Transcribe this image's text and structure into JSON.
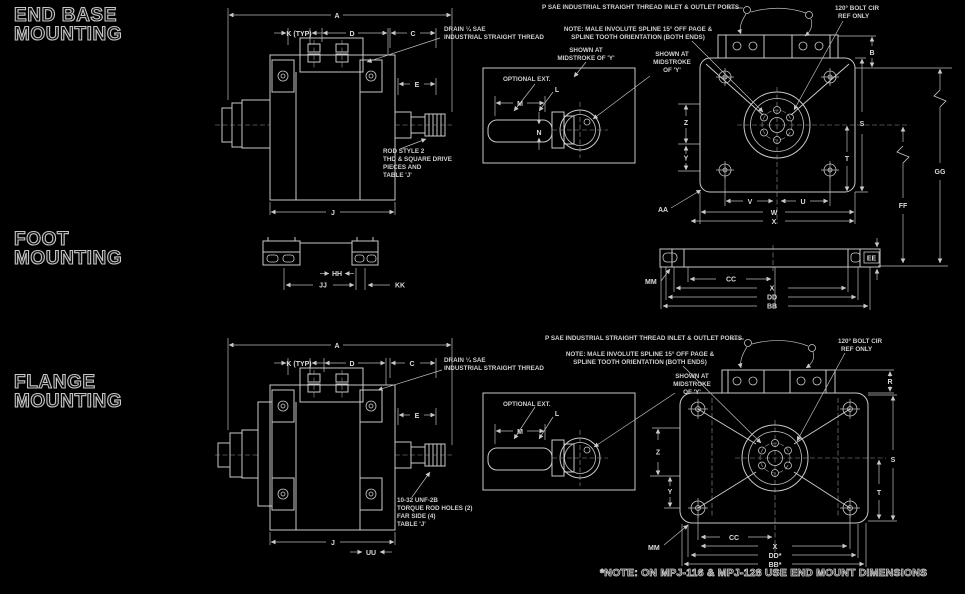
{
  "sections": {
    "end_base": {
      "l1": "END BASE",
      "l2": "MOUNTING"
    },
    "foot": {
      "l1": "FOOT",
      "l2": "MOUNTING"
    },
    "flange": {
      "l1": "FLANGE",
      "l2": "MOUNTING"
    }
  },
  "footnote": "*NOTE: ON MPJ-116 & MPJ-128 USE END MOUNT DIMENSIONS",
  "annotations": {
    "ports": "P SAE INDUSTRIAL STRAIGHT THREAD INLET & OUTLET PORTS",
    "spline1": "NOTE: MALE INVOLUTE SPLINE 15° OFF PAGE &",
    "spline2": "SPLINE TOOTH ORIENTATION (BOTH ENDS)",
    "shown_at": "SHOWN AT",
    "midstroke_of": "MIDSTROKE OF 'Y'",
    "midstroke": "MIDSTROKE",
    "of_y": "OF 'Y'",
    "bolt120_1": "120° BOLT CIR",
    "bolt120_2": "REF ONLY",
    "drain1": "DRAIN ¼ SAE",
    "drain2": "INDUSTRIAL STRAIGHT THREAD",
    "optional_ext": "OPTIONAL EXT.",
    "rod_note1": [
      "ROD STYLE 2",
      "THD & SQUARE DRIVE",
      "PIECES AND",
      "TABLE 'J'"
    ],
    "rod_note2": [
      "10-32 UNF-2B",
      "TORQUE ROD HOLES (2)",
      "FAR SIDE (4)",
      "TABLE 'J'"
    ]
  },
  "dims": {
    "a": "A",
    "b": "B",
    "c": "C",
    "d": "D",
    "e": "E",
    "j": "J",
    "k": "K (TYP)",
    "l": "L",
    "m": "M",
    "n": "N",
    "r": "R",
    "s": "S",
    "t": "T",
    "u": "U",
    "v": "V",
    "w": "W",
    "x": "X",
    "y": "Y",
    "z": "Z",
    "aa": "AA",
    "bb": "BB",
    "cc": "CC",
    "dd": "DD",
    "ee": "EE",
    "ff": "FF",
    "gg": "GG",
    "hh": "HH",
    "jj": "JJ",
    "kk": "KK",
    "mm": "MM",
    "uu": "UU",
    "bb_star": "BB*",
    "dd_star": "DD*"
  }
}
